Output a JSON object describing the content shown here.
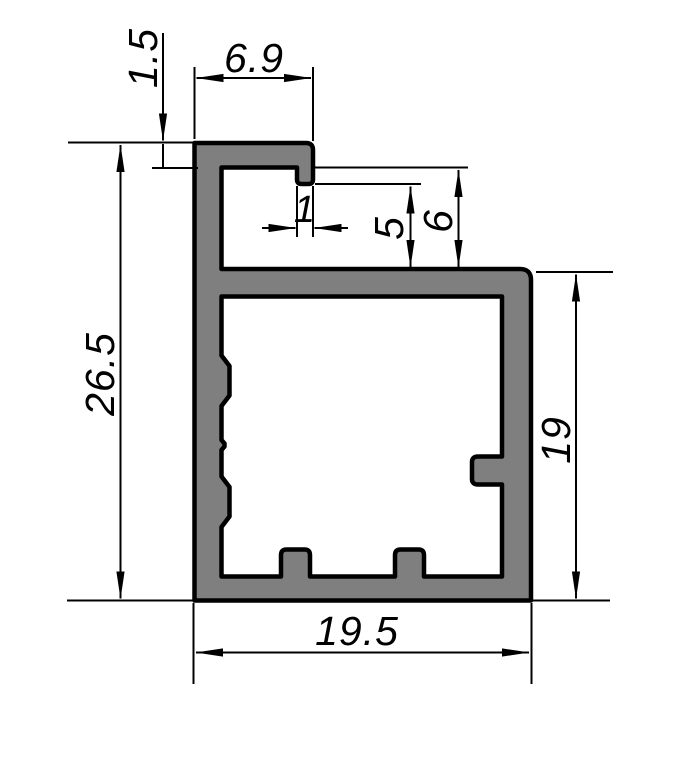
{
  "meta": {
    "background": "#ffffff",
    "profile_fill": "#7f7f7f",
    "line_color": "#000000",
    "drawing_kind": "aluminum-profile-cross-section"
  },
  "dims": {
    "flange_width": "6.9",
    "flange_thickness": "1.5",
    "lip_width": "1",
    "lip_depth": "5",
    "channel_depth": "6",
    "overall_height": "26.5",
    "body_height": "19",
    "overall_width": "19.5"
  }
}
